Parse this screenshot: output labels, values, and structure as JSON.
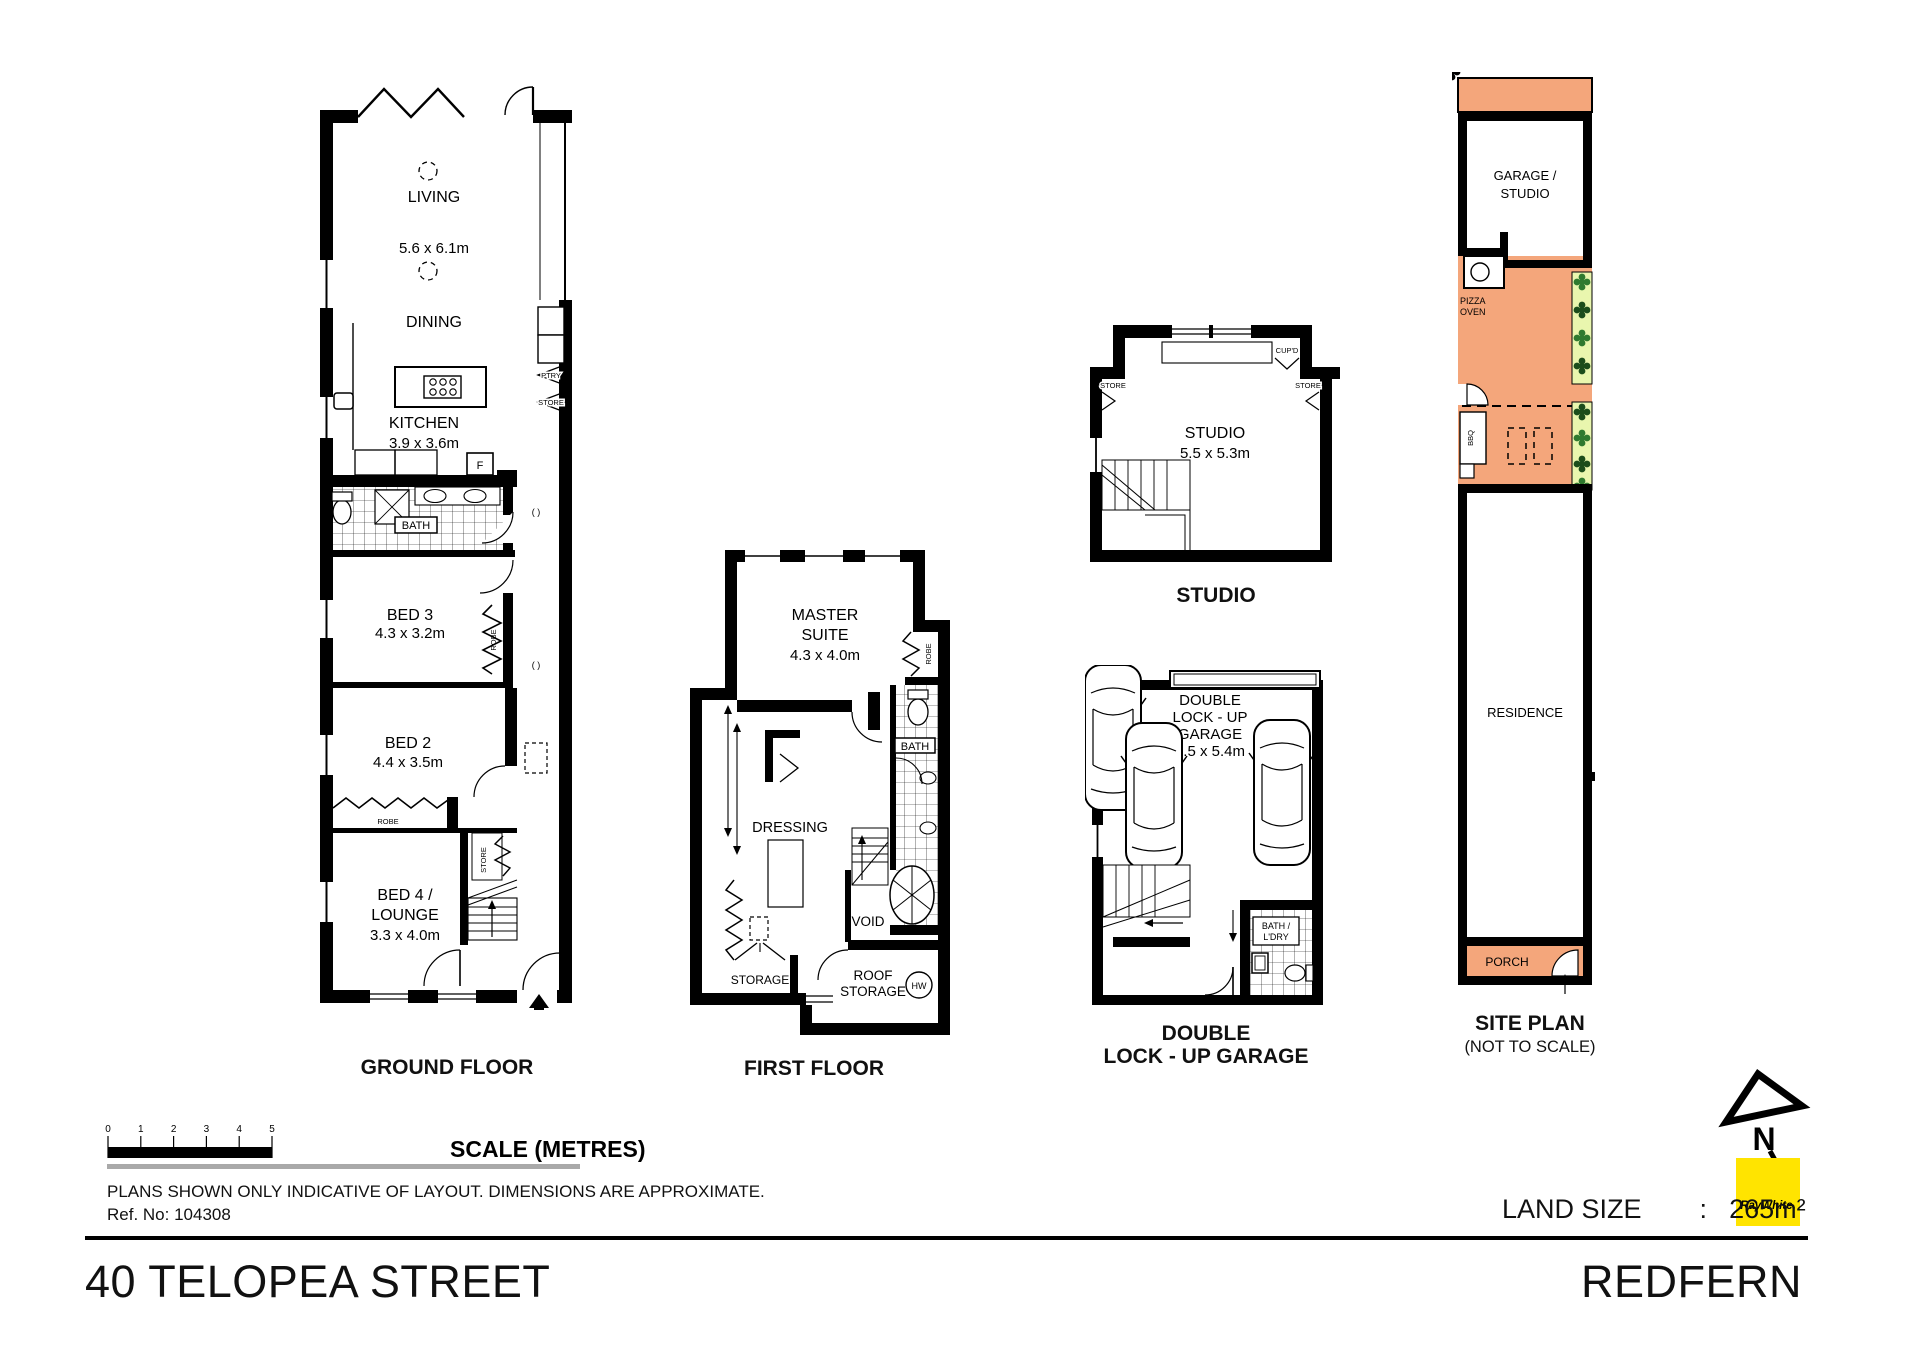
{
  "colors": {
    "orange": "#F4A67B",
    "green_light": "#E9F6AE",
    "green_dark": "#1B4D1B",
    "green_mid": "#2F7A2F",
    "yellow": "#FFE400",
    "gray_line": "#A9A9A9"
  },
  "plans": {
    "ground": {
      "caption": "GROUND FLOOR",
      "living": "LIVING",
      "living_dim": "5.6 x 6.1m",
      "dining": "DINING",
      "kitchen": "KITCHEN",
      "kitchen_dim": "3.9 x 3.6m",
      "fridge": "F",
      "pantry": "PTRY",
      "store": "STORE",
      "bath": "BATH",
      "bed3": "BED 3",
      "bed3_dim": "4.3 x 3.2m",
      "bed2": "BED 2",
      "bed2_dim": "4.4 x 3.5m",
      "bed4_line1": "BED 4 /",
      "bed4_line2": "LOUNGE",
      "bed4_dim": "3.3 x 4.0m",
      "robe": "ROBE",
      "window_symbol": "( )"
    },
    "first": {
      "caption": "FIRST FLOOR",
      "master_line1": "MASTER",
      "master_line2": "SUITE",
      "master_dim": "4.3 x 4.0m",
      "robe": "ROBE",
      "bath": "BATH",
      "dressing": "DRESSING",
      "void": "VOID",
      "storage": "STORAGE",
      "roof_line1": "ROOF",
      "roof_line2": "STORAGE",
      "hw": "HW"
    },
    "studio": {
      "caption": "STUDIO",
      "name": "STUDIO",
      "dim": "5.5 x 5.3m",
      "cupboard": "CUP'D",
      "store": "STORE"
    },
    "garage": {
      "caption_line1": "DOUBLE",
      "caption_line2": "LOCK - UP GARAGE",
      "label_line1": "DOUBLE",
      "label_line2": "LOCK - UP",
      "label_line3": "GARAGE",
      "dim": "5.5 x 5.4m",
      "bath_line1": "BATH /",
      "bath_line2": "L'DRY"
    },
    "site": {
      "caption_line1": "SITE PLAN",
      "caption_line2": "(NOT TO SCALE)",
      "garage_line1": "GARAGE /",
      "garage_line2": "STUDIO",
      "pizza_line1": "PIZZA",
      "pizza_line2": "OVEN",
      "bbq": "BBQ",
      "residence": "RESIDENCE",
      "porch": "PORCH"
    }
  },
  "scalebar": {
    "title": "SCALE (METRES)",
    "ticks": [
      "0",
      "1",
      "2",
      "3",
      "4",
      "5"
    ]
  },
  "disclaimer": {
    "line1": "PLANS SHOWN ONLY INDICATIVE OF LAYOUT.  DIMENSIONS ARE APPROXIMATE.",
    "line2": "Ref. No: 104308"
  },
  "land": {
    "label": "LAND SIZE",
    "separator": ":",
    "value": "265m²"
  },
  "north": {
    "letter": "N"
  },
  "brand": {
    "logo_text": "RayWhite."
  },
  "footer": {
    "address": "40 TELOPEA STREET",
    "suburb": "REDFERN"
  }
}
